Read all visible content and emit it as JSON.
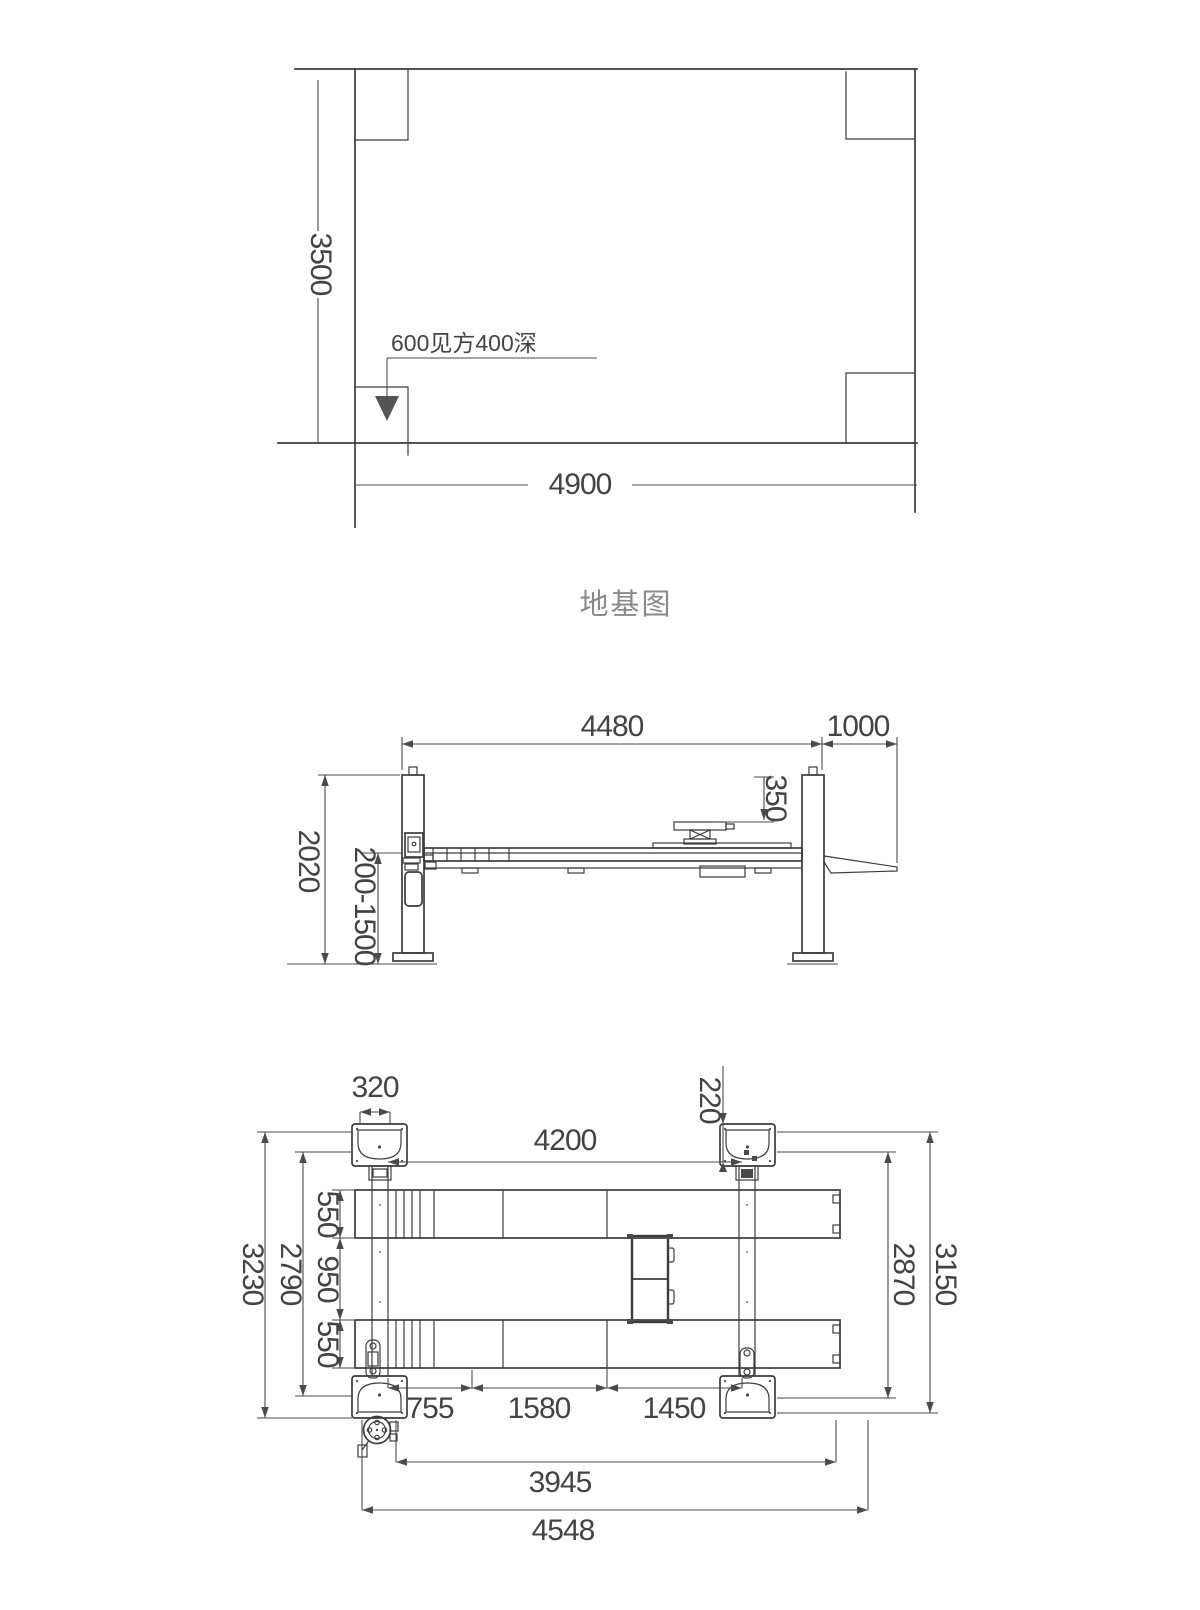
{
  "colors": {
    "line": "#3c3c3c",
    "dimension": "#4a4a4a",
    "text": "#434343",
    "title_text": "#8a8a8a",
    "marker_fill": "#555555"
  },
  "foundation_plan": {
    "title": "地基图",
    "pit_note": "600见方400深",
    "dims": {
      "height": "3500",
      "width": "4900"
    }
  },
  "side_elevation": {
    "dims": {
      "span": "4480",
      "ramp": "1000",
      "pad_height": "350",
      "column_height": "2020",
      "lift_range": "200-1500"
    }
  },
  "plan_view": {
    "dims": {
      "carriage_width": "320",
      "beam_offset": "220",
      "inner_span": "4200",
      "runway_width_top": "550",
      "track_gap": "950",
      "runway_width_bottom": "550",
      "left_inner": "2790",
      "left_outer": "3230",
      "right_inner": "2870",
      "right_outer": "3150",
      "seg_a": "755",
      "seg_b": "1580",
      "seg_c": "1450",
      "inner_length": "3945",
      "overall_length": "4548"
    }
  }
}
